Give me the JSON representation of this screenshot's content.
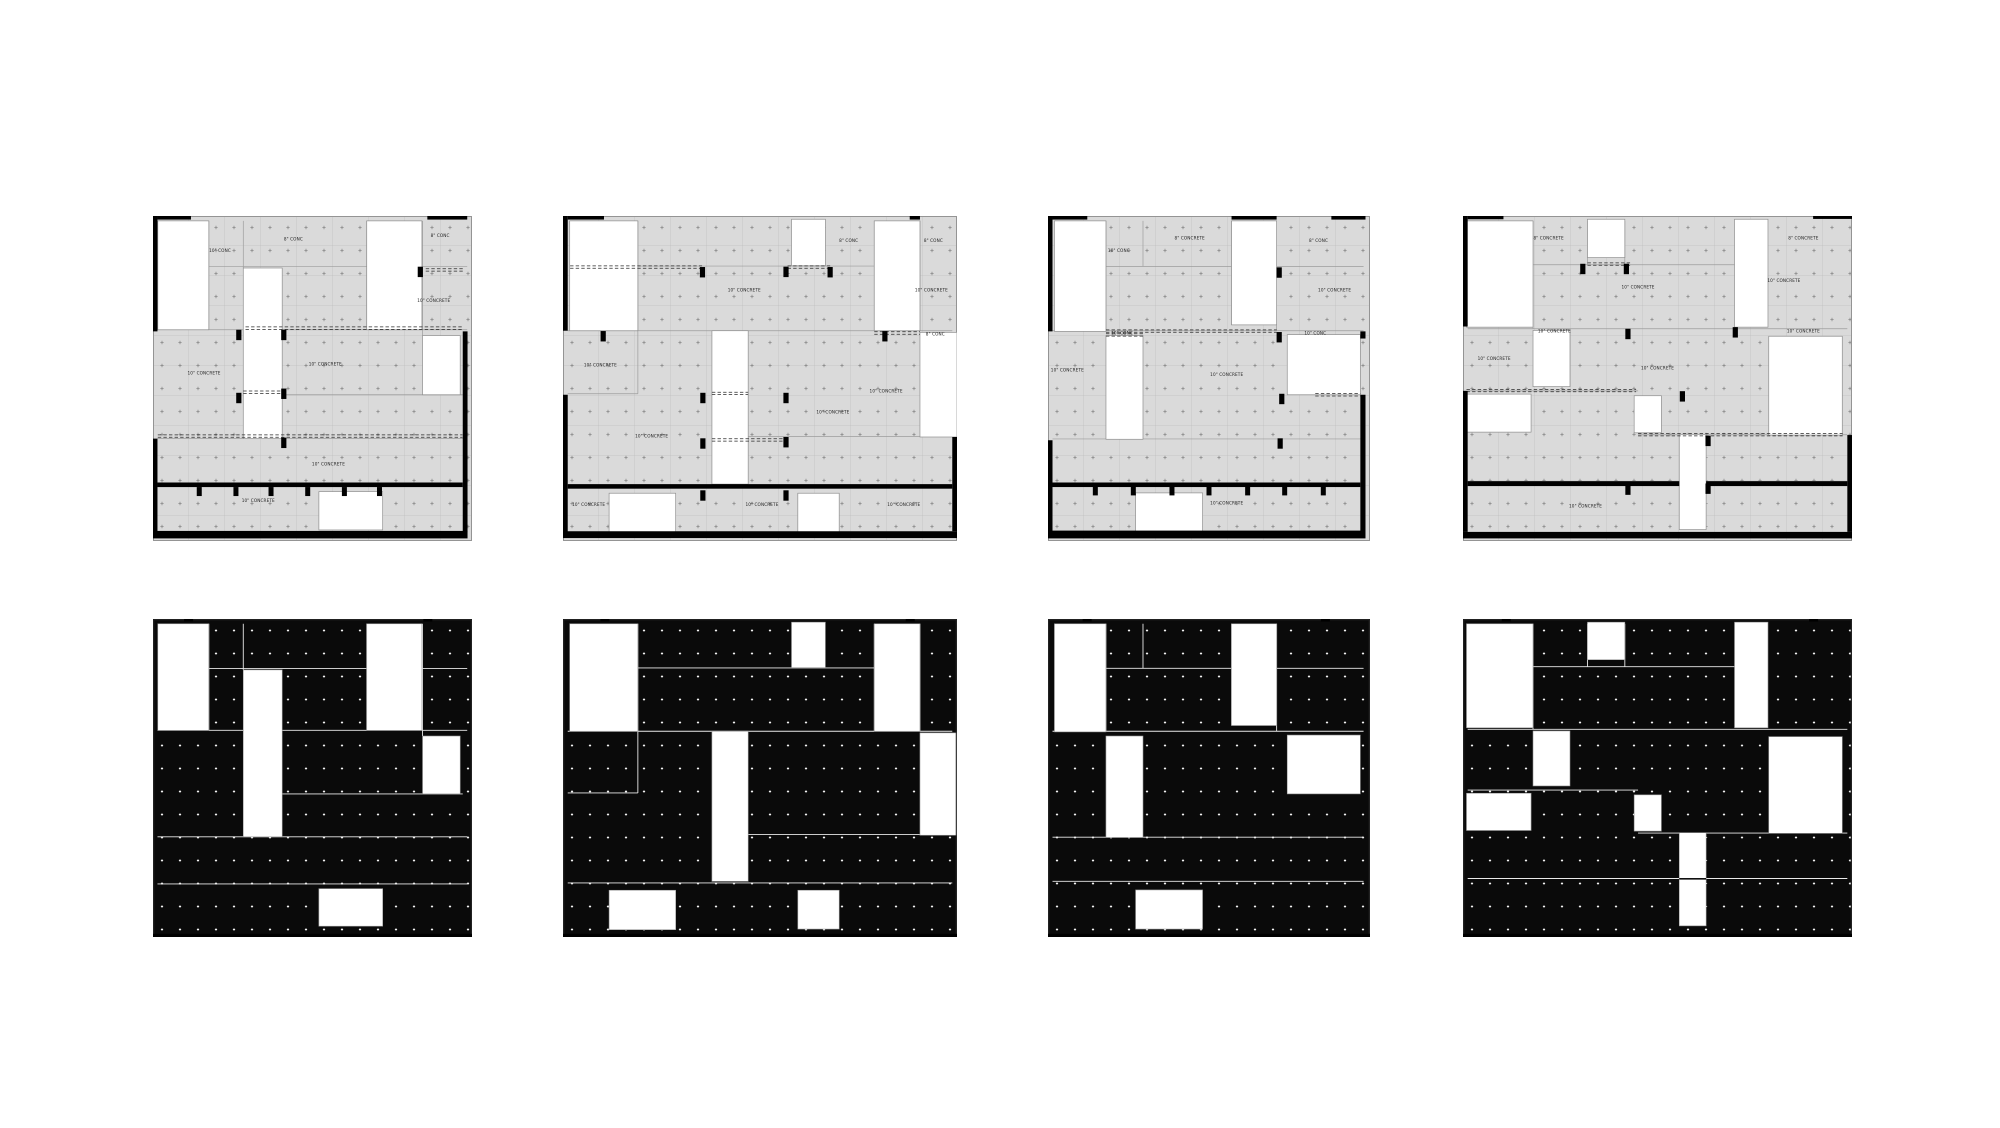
{
  "page": {
    "width": 2000,
    "height": 1128,
    "background": "#ffffff",
    "title": "Concrete slab plan studies"
  },
  "colors": {
    "slab": "#dadada",
    "slab_border": "#8a8a8a",
    "grid_line": "#b4b4b4",
    "seam": "#9c9c9c",
    "plus": "#6e6e6e",
    "void": "#ffffff",
    "void_stroke": "#8f8f8f",
    "wall": "#000000",
    "dash": "#2a2a2a",
    "label": "#1f1f1f",
    "solid_slab": "#0a0a0a",
    "solid_plus": "#f2f2f2",
    "solid_seam": "#e9e9e9",
    "solid_border": "#262626",
    "solid_void_stroke": "#9a9a9a",
    "dseam": "#111111"
  },
  "texture": {
    "plus_dx": 18,
    "plus_dy": 23,
    "grid_dx": 36,
    "grid_dy": 30,
    "plus_half": 1.7,
    "solid_plus_half": 1.1
  },
  "drawing": {
    "rows": [
      {
        "variant": "plan",
        "y": 216,
        "h": 325
      },
      {
        "variant": "solid",
        "y": 619,
        "h": 318
      }
    ],
    "columns": [
      {
        "x": 153,
        "w": 319,
        "scheme": 0
      },
      {
        "x": 563,
        "w": 394,
        "scheme": 1
      },
      {
        "x": 1048,
        "w": 322,
        "scheme": 2
      },
      {
        "x": 1463,
        "w": 389,
        "scheme": 3
      }
    ],
    "schemes": [
      {
        "voids": [
          [
            1.5,
            1.5,
            16,
            33.5
          ],
          [
            28.3,
            16,
            12.2,
            52.5
          ],
          [
            67,
            1.5,
            17.3,
            33.5
          ],
          [
            84.5,
            36.8,
            11.8,
            18.2
          ],
          [
            52,
            84.8,
            20,
            11.8
          ]
        ],
        "walls": [
          [
            0,
            0,
            1.4,
            35.5
          ],
          [
            0,
            68.5,
            1.4,
            28.8
          ],
          [
            1.4,
            0,
            10.5,
            1.1
          ],
          [
            86,
            0,
            12.5,
            1.1
          ],
          [
            97.1,
            35.5,
            1.5,
            61.8
          ],
          [
            0,
            96.9,
            98.6,
            2.3
          ],
          [
            1.4,
            82,
            95.7,
            1.4
          ]
        ],
        "tabs": [
          14.5,
          26,
          37,
          48.5,
          60,
          71
        ],
        "tab_y": 83.4,
        "columns": [
          [
            26.9,
            36.6
          ],
          [
            41,
            36.6
          ],
          [
            26.9,
            56
          ],
          [
            41,
            54.7
          ],
          [
            41,
            69.8
          ],
          [
            83.8,
            17.2
          ]
        ],
        "dashes": [
          [
            34.5,
            29,
            97
          ],
          [
            16.6,
            85.5,
            97.5
          ],
          [
            54.2,
            28.3,
            40.6
          ],
          [
            67.7,
            1.5,
            97
          ]
        ],
        "seams": [
          [
            "h",
            15.6,
            17.5,
            98.5
          ],
          [
            "h",
            35,
            1.4,
            98.5
          ],
          [
            "h",
            55,
            40.5,
            97.1
          ],
          [
            "h",
            68.5,
            1.4,
            98.5
          ],
          [
            "h",
            83.3,
            1.4,
            98.5
          ],
          [
            "v",
            28.3,
            1.5,
            16
          ],
          [
            "v",
            17.5,
            1.5,
            35
          ],
          [
            "v",
            67,
            1.5,
            35
          ],
          [
            "v",
            84.5,
            1.5,
            36.8
          ]
        ],
        "ticks": [
          11,
          86
        ],
        "dseams": [],
        "labels": [
          {
            "t": "8\" CONC",
            "x": 44,
            "y": 7.5
          },
          {
            "t": "10\" CONC",
            "x": 21,
            "y": 11
          },
          {
            "t": "8\" CONC",
            "x": 90,
            "y": 6.5
          },
          {
            "t": "10\" CONCRETE",
            "x": 88,
            "y": 26.5
          },
          {
            "t": "10\" CONCRETE",
            "x": 54,
            "y": 46
          },
          {
            "t": "10\" CONCRETE",
            "x": 16,
            "y": 48.8
          },
          {
            "t": "10\" CONCRETE",
            "x": 55,
            "y": 76.8
          },
          {
            "t": "10\" CONCRETE",
            "x": 33,
            "y": 88
          }
        ]
      },
      {
        "voids": [
          [
            1.7,
            1.5,
            17.3,
            33.8
          ],
          [
            58,
            1,
            8.6,
            14.3
          ],
          [
            79,
            1.5,
            11.6,
            33.8
          ],
          [
            37.8,
            35.3,
            9.2,
            47.2
          ],
          [
            90.6,
            35.8,
            9.4,
            32.2
          ],
          [
            11.7,
            85.3,
            16.9,
            12.4
          ],
          [
            59.6,
            85.3,
            10.5,
            12.2
          ]
        ],
        "walls": [
          [
            0,
            0,
            1.2,
            35.3
          ],
          [
            0,
            55,
            1.2,
            42.8
          ],
          [
            1.2,
            0,
            9.2,
            1.1
          ],
          [
            88,
            0,
            2.6,
            1.1
          ],
          [
            98.8,
            68,
            1.2,
            29
          ],
          [
            0,
            97,
            100,
            2.1
          ],
          [
            1.2,
            82.5,
            97.6,
            1.4
          ]
        ],
        "tabs": [],
        "tab_y": 0,
        "columns": [
          [
            35.4,
            17.3
          ],
          [
            56.6,
            17.2
          ],
          [
            67.8,
            17.3
          ],
          [
            10.2,
            37
          ],
          [
            81.7,
            37
          ],
          [
            35.5,
            56
          ],
          [
            56.6,
            56
          ],
          [
            35.5,
            70
          ],
          [
            56.6,
            69.6
          ],
          [
            35.5,
            86
          ],
          [
            56.6,
            86
          ]
        ],
        "dashes": [
          [
            15.7,
            1.8,
            35.3
          ],
          [
            15.7,
            57,
            68
          ],
          [
            36,
            79,
            90.6
          ],
          [
            54.6,
            37.8,
            47
          ],
          [
            68.9,
            37.8,
            56.6
          ]
        ],
        "seams": [
          [
            "h",
            15.4,
            19,
            79
          ],
          [
            "h",
            35.3,
            1.2,
            98.8
          ],
          [
            "h",
            54.7,
            1.2,
            19
          ],
          [
            "h",
            67.8,
            47,
            98.8
          ],
          [
            "h",
            83,
            1.2,
            98.8
          ],
          [
            "v",
            19,
            1.5,
            54.7
          ],
          [
            "v",
            79,
            1.5,
            35.3
          ],
          [
            "v",
            90.6,
            1.5,
            35.3
          ]
        ],
        "ticks": [
          10.5,
          88
        ],
        "dseams": [],
        "labels": [
          {
            "t": "8\" CONC",
            "x": 72.5,
            "y": 8
          },
          {
            "t": "8\" CONC",
            "x": 94,
            "y": 8
          },
          {
            "t": "10\" CONCRETE",
            "x": 46,
            "y": 23.3
          },
          {
            "t": "10\" CONCRETE",
            "x": 93.5,
            "y": 23.3
          },
          {
            "t": "8\" CONC",
            "x": 94.5,
            "y": 36.8
          },
          {
            "t": "10\" CONCRETE",
            "x": 9.5,
            "y": 46.3
          },
          {
            "t": "10\" CONCRETE",
            "x": 82,
            "y": 54.3
          },
          {
            "t": "10\" CONCRETE",
            "x": 68.5,
            "y": 60.8
          },
          {
            "t": "10\" CONCRETE",
            "x": 22.5,
            "y": 68.2
          },
          {
            "t": "10\" CONCRETE",
            "x": 6.5,
            "y": 89.3
          },
          {
            "t": "10\" CONCRETE",
            "x": 50.5,
            "y": 89.3
          },
          {
            "t": "10\" CONCRETE",
            "x": 86.5,
            "y": 89.3
          }
        ]
      },
      {
        "voids": [
          [
            2,
            1.5,
            16,
            34
          ],
          [
            57,
            1.5,
            14,
            32
          ],
          [
            18,
            36.8,
            11.5,
            31.9
          ],
          [
            74.3,
            36.5,
            22.7,
            18.5
          ],
          [
            27.2,
            85.2,
            20.8,
            12.3
          ]
        ],
        "walls": [
          [
            0,
            0,
            1.4,
            35.5
          ],
          [
            0,
            69,
            1.4,
            28.2
          ],
          [
            1.4,
            0,
            10.8,
            1.1
          ],
          [
            57,
            0,
            14,
            1.1
          ],
          [
            88,
            0,
            10.6,
            1.1
          ],
          [
            97,
            35.5,
            1.6,
            2.2
          ],
          [
            97,
            55,
            1.6,
            42.1
          ],
          [
            0,
            96.8,
            98.6,
            2.4
          ],
          [
            1.4,
            82,
            95.6,
            1.4
          ]
        ],
        "tabs": [
          14.7,
          26.5,
          38.5,
          50,
          62,
          73.5,
          85.5
        ],
        "tab_y": 83.2,
        "columns": [
          [
            71.8,
            17.4
          ],
          [
            71.8,
            37.3
          ],
          [
            72.6,
            56.3
          ],
          [
            72.1,
            70
          ]
        ],
        "dashes": [
          [
            35.4,
            18,
            71
          ],
          [
            36.6,
            18,
            29.6
          ],
          [
            55,
            83,
            97
          ]
        ],
        "seams": [
          [
            "h",
            15.5,
            18,
            98
          ],
          [
            "h",
            35.3,
            1.4,
            98
          ],
          [
            "h",
            68.6,
            1.4,
            98
          ],
          [
            "h",
            82.5,
            1.4,
            98
          ],
          [
            "v",
            29.5,
            1.5,
            15.5
          ],
          [
            "v",
            18,
            1.5,
            35.3
          ],
          [
            "v",
            57,
            1.5,
            33.5
          ],
          [
            "v",
            71,
            1.5,
            35.3
          ]
        ],
        "ticks": [
          12,
          86
        ],
        "dseams": [],
        "labels": [
          {
            "t": "8\" CONCRETE",
            "x": 44,
            "y": 7.3
          },
          {
            "t": "10\" CONC",
            "x": 22,
            "y": 11
          },
          {
            "t": "8\" CONC",
            "x": 84,
            "y": 8
          },
          {
            "t": "10\" CONCRETE",
            "x": 89,
            "y": 23.2
          },
          {
            "t": "10\" CONC",
            "x": 23,
            "y": 36.5
          },
          {
            "t": "10\" CONC",
            "x": 83,
            "y": 36.5
          },
          {
            "t": "10\" CONCRETE",
            "x": 6,
            "y": 47.8
          },
          {
            "t": "10\" CONCRETE",
            "x": 55.5,
            "y": 49.3
          },
          {
            "t": "10\" CONCRETE",
            "x": 55.5,
            "y": 88.7
          }
        ]
      },
      {
        "voids": [
          [
            0.9,
            1.5,
            17.1,
            32.7
          ],
          [
            32,
            1,
            9.6,
            11.8
          ],
          [
            69.8,
            1,
            8.6,
            33.2
          ],
          [
            18,
            35.2,
            9.5,
            17.3
          ],
          [
            0.9,
            54.8,
            16.6,
            11.7
          ],
          [
            44,
            55.3,
            7,
            11.4
          ],
          [
            55.6,
            67.2,
            6.9,
            29.3
          ],
          [
            78.6,
            37,
            18.9,
            30.4
          ]
        ],
        "walls": [
          [
            0,
            0,
            1.2,
            34
          ],
          [
            0,
            53.8,
            1.2,
            43.4
          ],
          [
            1.2,
            0,
            9.2,
            1
          ],
          [
            90,
            0,
            10,
            0.9
          ],
          [
            98.8,
            67.4,
            1.2,
            29.8
          ],
          [
            0,
            97.2,
            100,
            2
          ],
          [
            1.2,
            81.6,
            54.4,
            1.5
          ],
          [
            62.5,
            81.6,
            36.3,
            1.5
          ]
        ],
        "tabs": [],
        "tab_y": 0,
        "columns": [
          [
            30.8,
            16.3
          ],
          [
            42,
            16.3
          ],
          [
            42.4,
            36.3
          ],
          [
            70,
            35.8
          ],
          [
            56.4,
            55.5
          ],
          [
            63,
            69.2
          ],
          [
            42.4,
            84.2
          ],
          [
            63,
            83.9
          ]
        ],
        "dashes": [
          [
            14.8,
            32,
            43
          ],
          [
            53.7,
            0.9,
            44.5
          ],
          [
            67.3,
            45,
            97.6
          ]
        ],
        "seams": [
          [
            "h",
            15,
            18,
            69.8
          ],
          [
            "h",
            34.7,
            1.2,
            98.8
          ],
          [
            "h",
            53.8,
            1.2,
            45
          ],
          [
            "h",
            67.3,
            45,
            98.8
          ],
          [
            "h",
            81.6,
            1.2,
            98.8
          ],
          [
            "v",
            18,
            1.5,
            34.7
          ],
          [
            "v",
            32,
            1.5,
            15
          ],
          [
            "v",
            41.6,
            1.5,
            15
          ]
        ],
        "ticks": [
          11,
          90
        ],
        "dseams": [
          [
            81.7,
            55.6,
            62.5
          ]
        ],
        "labels": [
          {
            "t": "8\" CONCRETE",
            "x": 22,
            "y": 7.3
          },
          {
            "t": "8\" CONCRETE",
            "x": 87.5,
            "y": 7.3
          },
          {
            "t": "10\" CONCRETE",
            "x": 45,
            "y": 22.3
          },
          {
            "t": "10\" CONCRETE",
            "x": 82.5,
            "y": 20.3
          },
          {
            "t": "10\" CONCRETE",
            "x": 23.5,
            "y": 35.8
          },
          {
            "t": "10\" CONCRETE",
            "x": 87.5,
            "y": 35.8
          },
          {
            "t": "10\" CONCRETE",
            "x": 8,
            "y": 44.3
          },
          {
            "t": "10\" CONCRETE",
            "x": 50,
            "y": 47.3
          },
          {
            "t": "10\" CONCRETE",
            "x": 31.5,
            "y": 89.7
          }
        ]
      }
    ]
  }
}
